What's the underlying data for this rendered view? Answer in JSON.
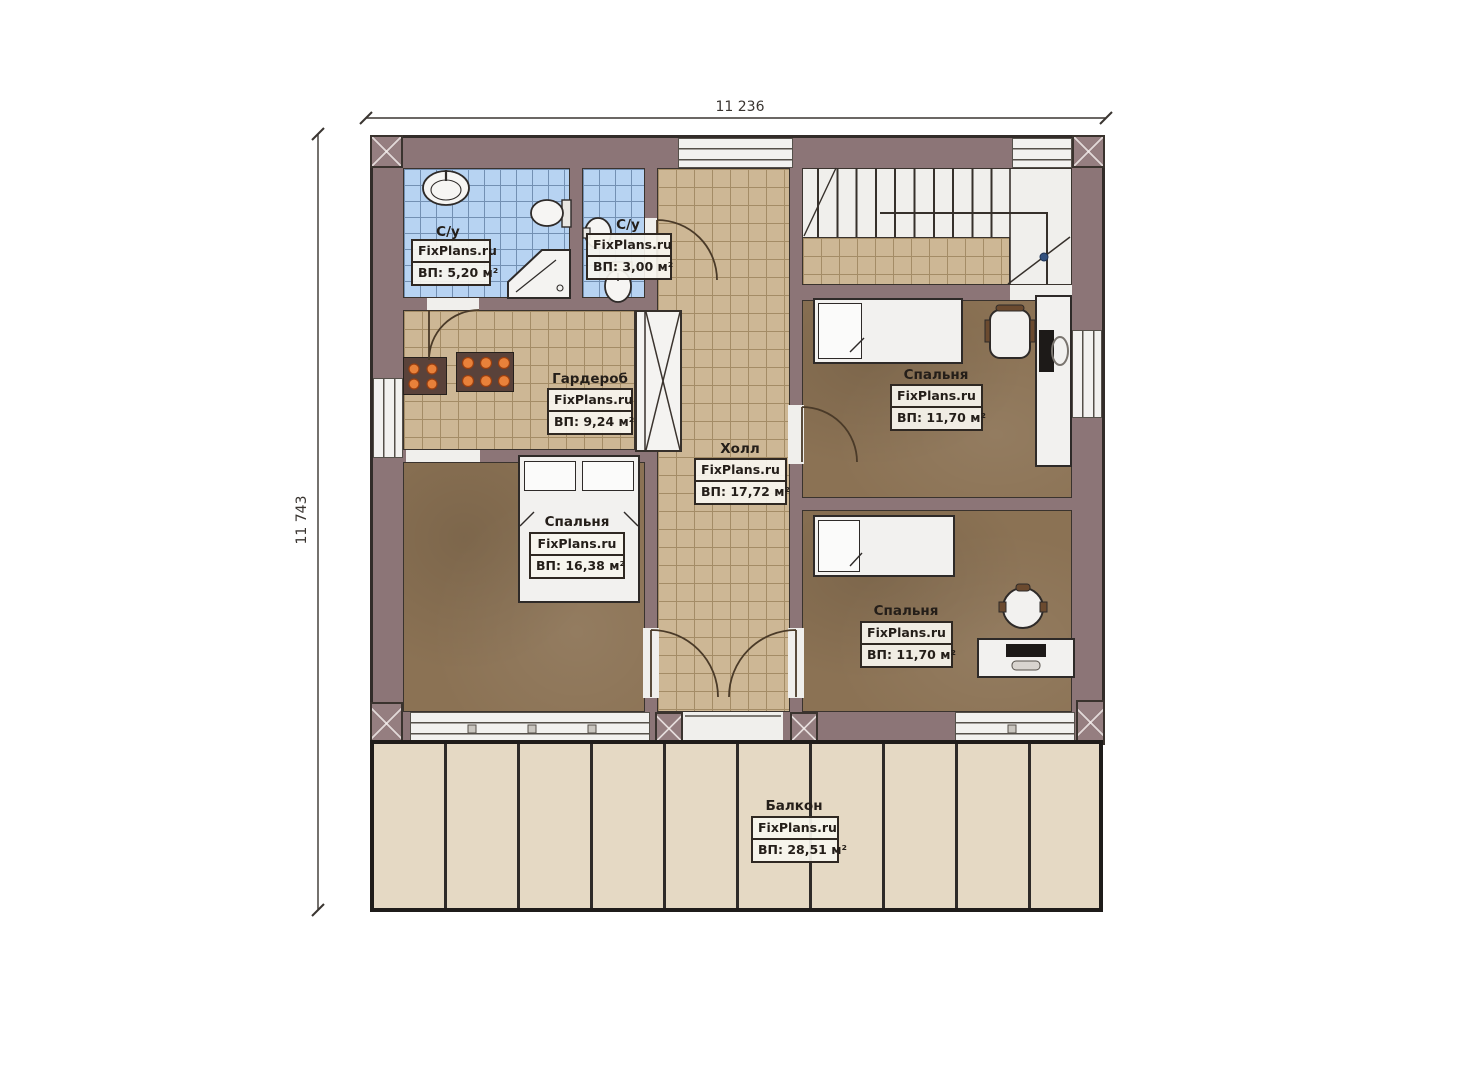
{
  "dimensions": {
    "top": "11 236",
    "left": "11 743"
  },
  "rooms": [
    {
      "key": "bathroom-1",
      "name": "С/у",
      "brand": "FixPlans.ru",
      "area": "ВП: 5,20 м²"
    },
    {
      "key": "bathroom-2",
      "name": "С/у",
      "brand": "FixPlans.ru",
      "area": "ВП: 3,00 м²"
    },
    {
      "key": "wardrobe",
      "name": "Гардероб",
      "brand": "FixPlans.ru",
      "area": "ВП: 9,24 м²"
    },
    {
      "key": "hall",
      "name": "Холл",
      "brand": "FixPlans.ru",
      "area": "ВП: 17,72 м²"
    },
    {
      "key": "bedroom-top-right",
      "name": "Спальня",
      "brand": "FixPlans.ru",
      "area": "ВП: 11,70 м²"
    },
    {
      "key": "bedroom-master",
      "name": "Спальня",
      "brand": "FixPlans.ru",
      "area": "ВП: 16,38 м²"
    },
    {
      "key": "bedroom-bottom-right",
      "name": "Спальня",
      "brand": "FixPlans.ru",
      "area": "ВП: 11,70 м²"
    },
    {
      "key": "balcony",
      "name": "Балкон",
      "brand": "FixPlans.ru",
      "area": "ВП: 28,51 м²"
    }
  ],
  "colors": {
    "wall": "#8c7577",
    "bathroom_tile": "#b7d3f2",
    "hall_tile": "#cdb795",
    "bedroom_floor": "#8b7254",
    "balcony_floor": "#e5d9c4",
    "cabinet_accent": "#e8813a",
    "outline": "#322c29"
  }
}
